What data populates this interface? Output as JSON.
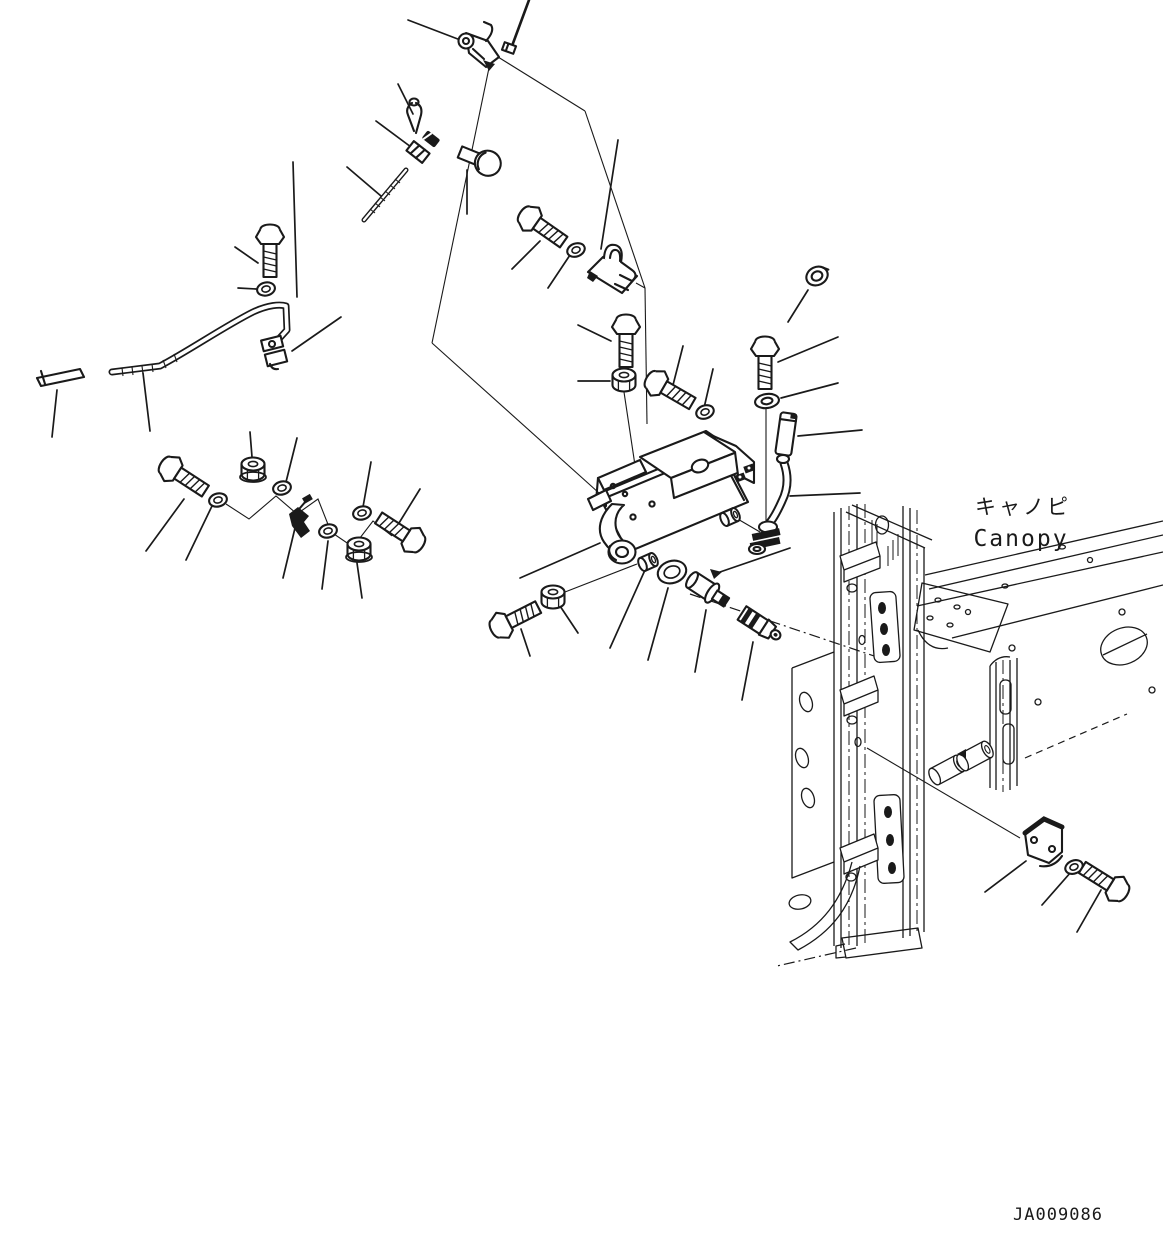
{
  "document": {
    "type": "exploded-parts-diagram",
    "labels": {
      "location_jp": "キャノピ",
      "location_en": "Canopy",
      "drawing_number": "JA009086"
    },
    "colors": {
      "background": "#ffffff",
      "line": "#1a1a1a"
    },
    "parts": [
      "lock-lever",
      "small-pin",
      "cotter-pin",
      "spring-pin",
      "pin-sleeve",
      "clevis-pin",
      "threaded-rod",
      "hex-bolt",
      "plain-washer",
      "control-rod",
      "rod-end-clevis",
      "short-rod",
      "flange-nut",
      "grease-fitting",
      "latch-keeper",
      "lock-washer",
      "hex-nut",
      "lock-bracket-assembly",
      "bushing",
      "rubber-sleeve",
      "drain-hose",
      "elbow-fitting",
      "release-plunger",
      "large-washer",
      "mounting-bracket",
      "canopy-frame"
    ]
  }
}
